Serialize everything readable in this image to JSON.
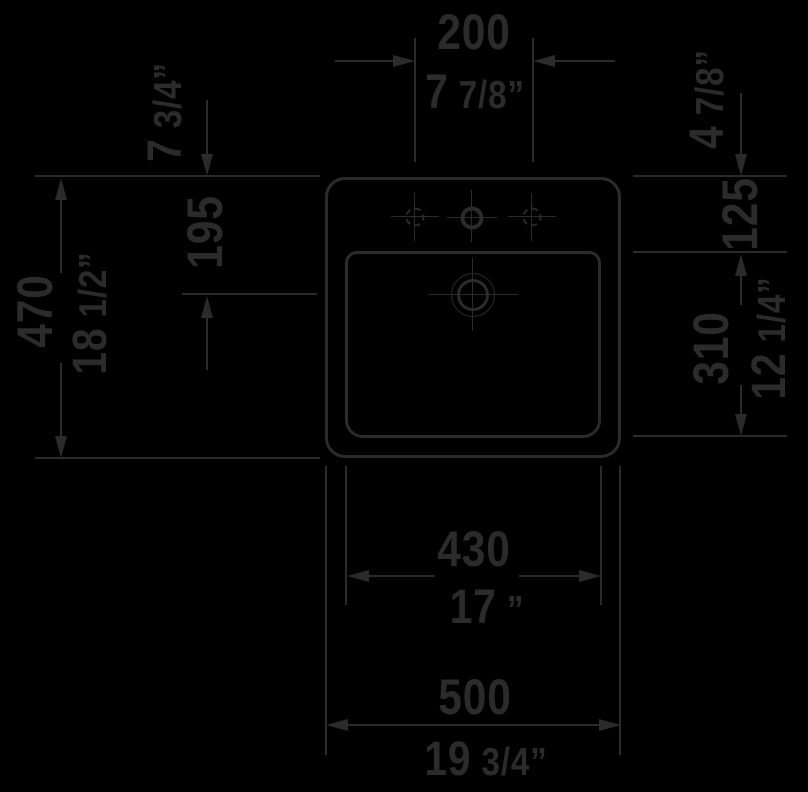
{
  "meta": {
    "title": "Washbasin technical drawing - plan view",
    "background_color": "#000000",
    "line_color": "#2b2b2b",
    "units": "mm over inches"
  },
  "dimensions": {
    "tap_hole_spacing": {
      "mm": "200",
      "inch": "7 7/8”"
    },
    "rim_to_drain": {
      "mm": "195",
      "inch": "7 3/4”"
    },
    "overall_depth": {
      "mm": "470",
      "inch": "18 1/2”"
    },
    "rim_to_basin_top": {
      "mm": "125",
      "inch": "4 7/8”"
    },
    "basin_depth": {
      "mm": "310",
      "inch": "12 1/4”"
    },
    "basin_width": {
      "mm": "430",
      "inch": "17 ”"
    },
    "overall_width": {
      "mm": "500",
      "inch": "19 3/4”"
    }
  }
}
